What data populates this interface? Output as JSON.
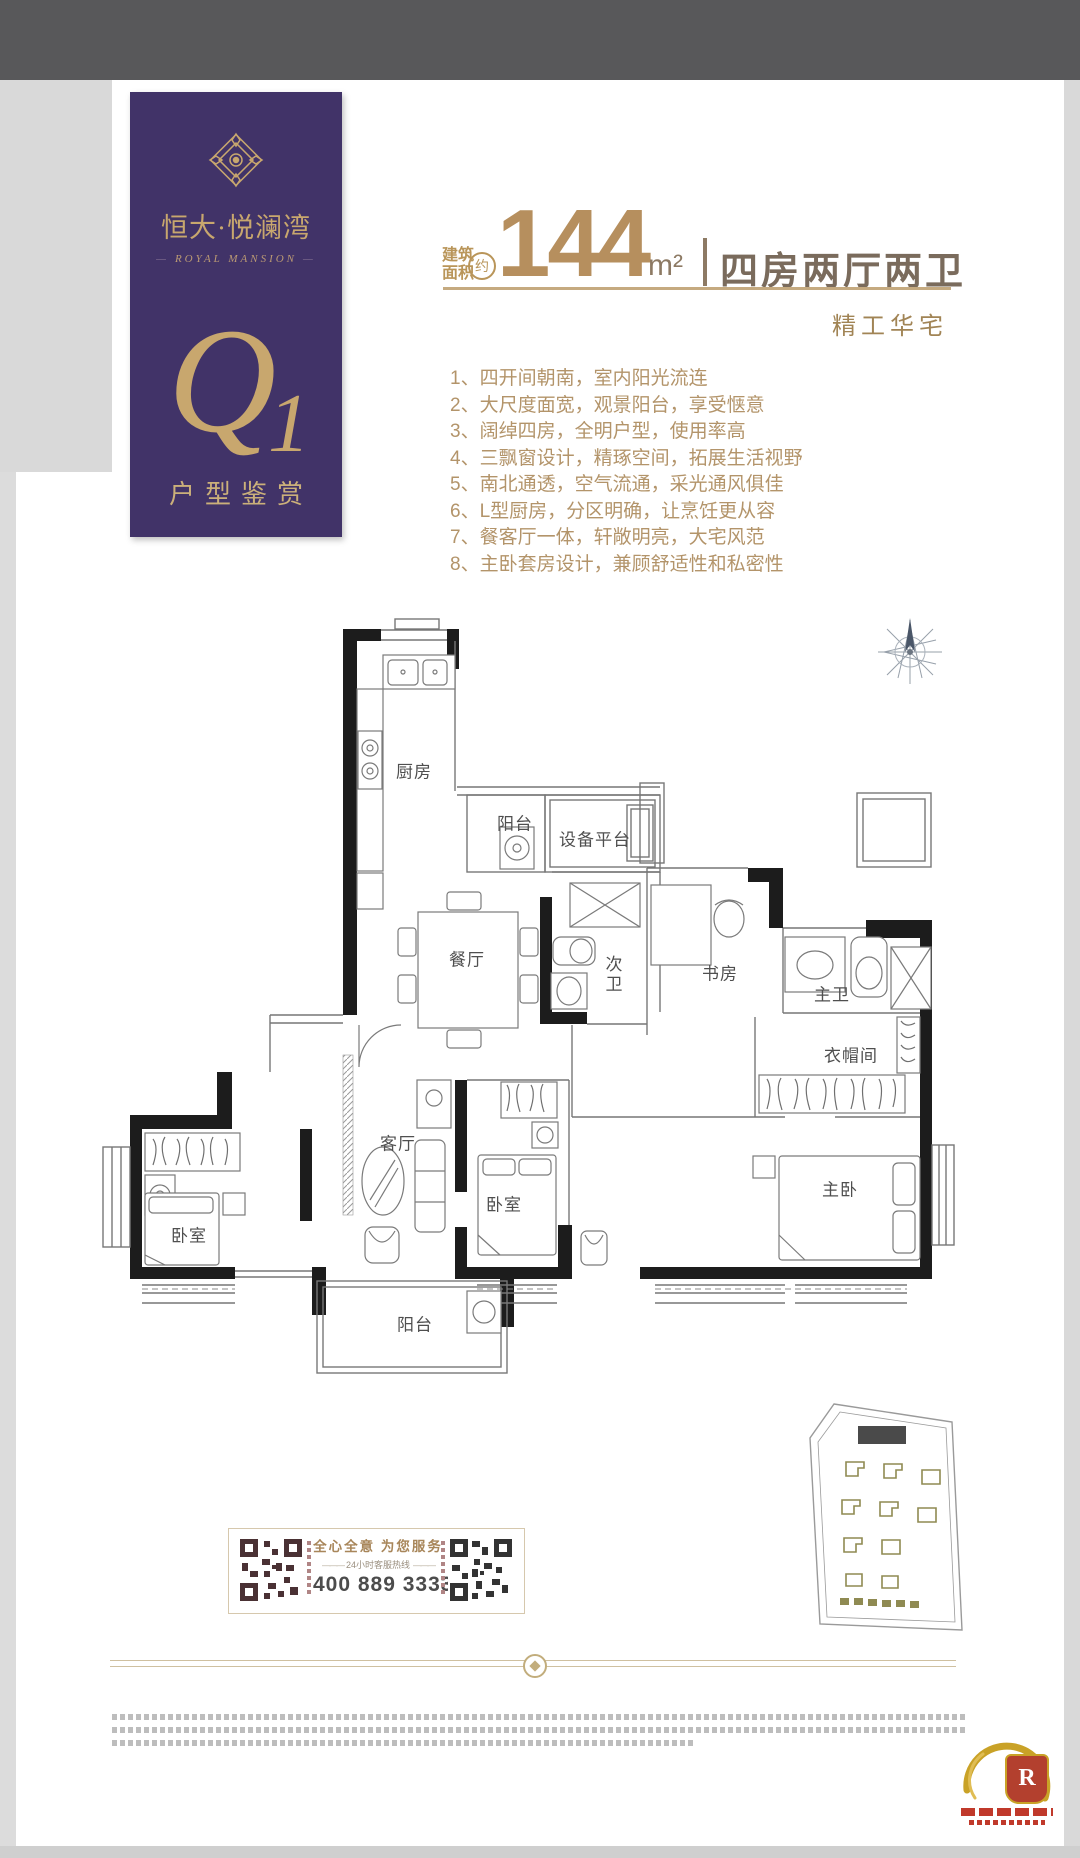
{
  "banner": {
    "brand_cn": "恒大·悦澜湾",
    "brand_en": "ROYAL MANSION",
    "unit_q": "Q",
    "unit_1": "1",
    "caption": "户型鉴赏"
  },
  "headline": {
    "area_label_1": "建筑",
    "area_label_2": "面积",
    "approx": "约",
    "value": "144",
    "unit": "m²",
    "layout": "四房两厅两卫",
    "tagline": "精工华宅"
  },
  "features": [
    "1、四开间朝南，室内阳光流连",
    "2、大尺度面宽，观景阳台，享受惬意",
    "3、阔绰四房，全明户型，使用率高",
    "4、三飘窗设计，精琢空间，拓展生活视野",
    "5、南北通透，空气流通，采光通风俱佳",
    "6、L型厨房，分区明确，让烹饪更从容",
    "7、餐客厅一体，轩敞明亮，大宅风范",
    "8、主卧套房设计，兼顾舒适性和私密性"
  ],
  "floorplan": {
    "rooms": {
      "kitchen": "厨房",
      "balcony_top": "阳台",
      "equipment_platform": "设备平台",
      "dining": "餐厅",
      "second_bath": "次卫",
      "study": "书房",
      "master_bath": "主卫",
      "cloakroom": "衣帽间",
      "bedroom_left": "卧室",
      "living": "客厅",
      "bedroom_mid": "卧室",
      "master_bedroom": "主卧",
      "balcony_bottom": "阳台"
    }
  },
  "service": {
    "slogan": "全心全意 为您服务",
    "hotline_label": "24小时客服热线",
    "hotline": "400 889 3333"
  },
  "logo": {
    "letter": "R"
  },
  "colors": {
    "purple": "#413368",
    "gold": "#c8a76e",
    "bronze": "#b68f5e",
    "text_brown": "#7a6b5c",
    "list_gold": "#b3946a",
    "wall": "#1c1c1c",
    "olive": "#8f8a52",
    "red": "#c0392b"
  }
}
